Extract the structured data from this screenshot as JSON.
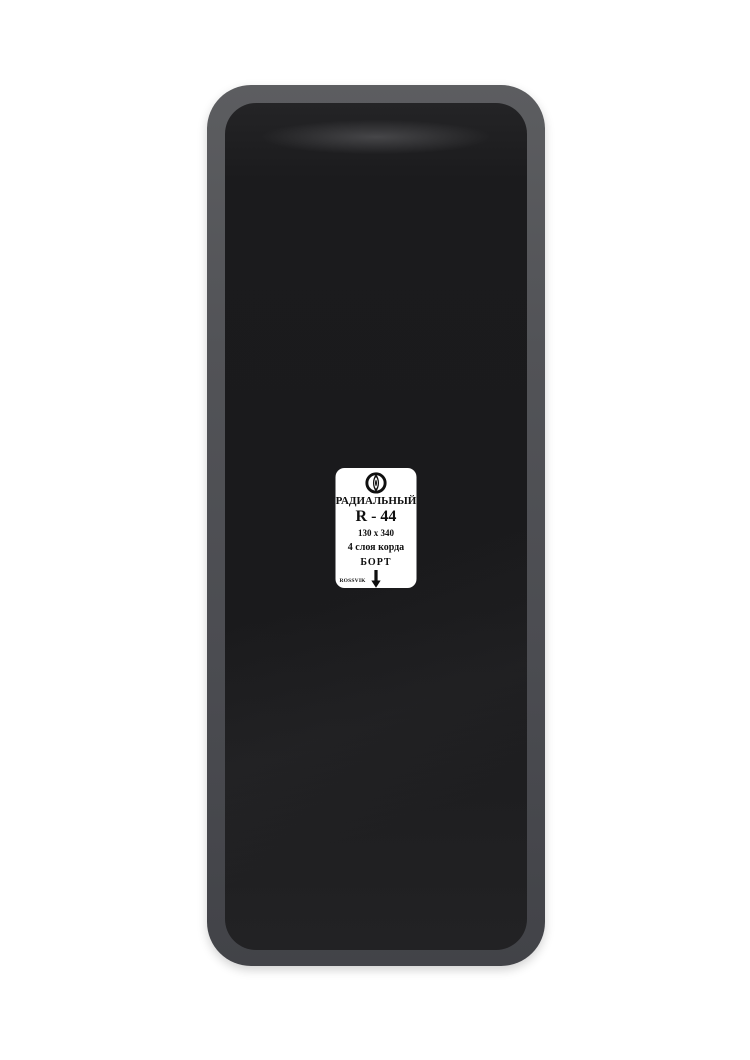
{
  "label": {
    "type_text": "РАДИАЛЬНЫЙ",
    "model": "R - 44",
    "size": "130 x 340",
    "cord_layers": "4 слоя корда",
    "bead_text": "БОРТ",
    "brand": "ROSSVIK",
    "logo_icon": "rossvik-leaf-logo",
    "direction_icon": "down-arrow"
  },
  "colors": {
    "background": "#ffffff",
    "patch_edge_top": "#5c5d60",
    "patch_edge_bottom": "#424348",
    "patch_rubber": "#1b1b1d",
    "label_background": "#ffffff",
    "label_text": "#0f0f0f"
  }
}
